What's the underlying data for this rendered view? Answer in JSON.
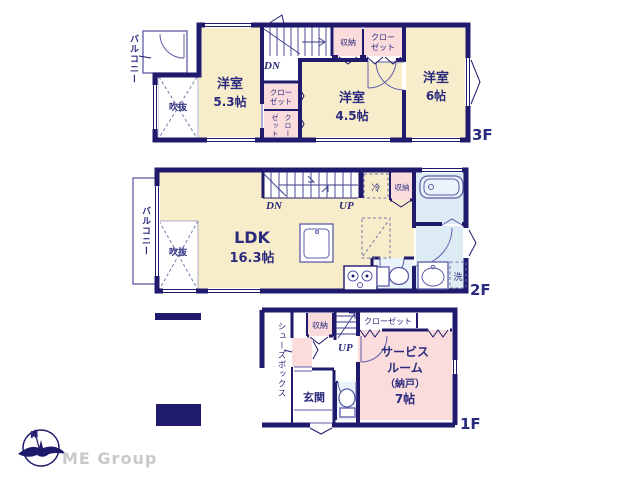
{
  "brand": {
    "name": "ME Group",
    "compass_north": "N"
  },
  "colors": {
    "wall": "#1f1a6b",
    "room_cream": "#f8edca",
    "closet_pink": "#fadcdc",
    "wet_blue": "#ddebf5",
    "text_navy": "#2b2b7e",
    "brand_gray": "#c9c9c9"
  },
  "floor3": {
    "floor_label": "3F",
    "balcony_label": "バルコニー",
    "void_label": "吹抜",
    "stairs_down": "DN",
    "room1_name": "洋室",
    "room1_size": "5.3帖",
    "room2_name": "洋室",
    "room2_size": "4.5帖",
    "room3_name": "洋室",
    "room3_size": "6帖",
    "storage_label": "収納",
    "closet_top_line1": "クロー",
    "closet_top_line2": "ゼット",
    "closet_mid_line1": "クロー",
    "closet_mid_line2": "ゼット",
    "closet_low_col1": "クロー",
    "closet_low_col2": "ゼット"
  },
  "floor2": {
    "floor_label": "2F",
    "balcony_label": "バルコニー",
    "void_label": "吹抜",
    "stairs_down": "DN",
    "stairs_up": "UP",
    "ldk_name": "LDK",
    "ldk_size": "16.3帖",
    "fridge_label": "冷",
    "storage_label": "収納",
    "laundry_label": "洗"
  },
  "floor1": {
    "floor_label": "1F",
    "shoe_box_label": "シューズボックス",
    "storage_label": "収納",
    "stairs_up": "UP",
    "closet_label": "クローゼット",
    "entrance_label": "玄関",
    "service_line1": "サービス",
    "service_line2": "ルーム",
    "service_line3": "（納戸）",
    "service_line4": "7帖"
  }
}
